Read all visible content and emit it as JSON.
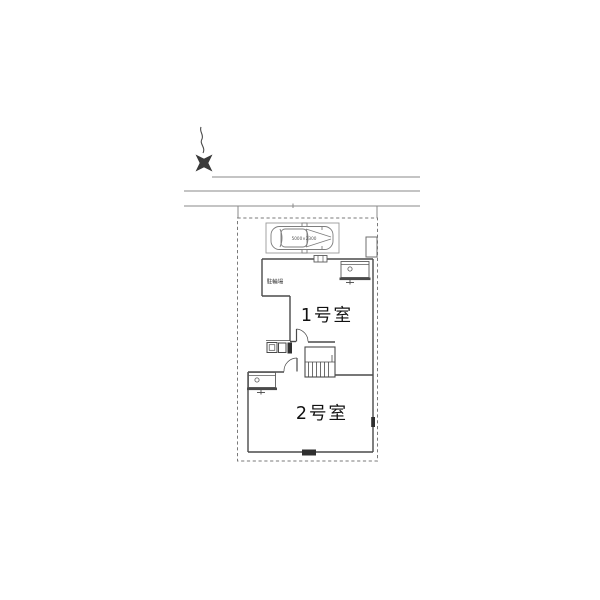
{
  "plan": {
    "labels": {
      "room1": "1号室",
      "room2": "2号室",
      "bike_parking": "駐輪場",
      "car_dimension": "5000×2300"
    },
    "colors": {
      "background": "#ffffff",
      "site_line": "#8a8a8a",
      "building_line": "#4a4a4a",
      "text": "#111111",
      "dark_fill": "#2f2f2f"
    }
  }
}
